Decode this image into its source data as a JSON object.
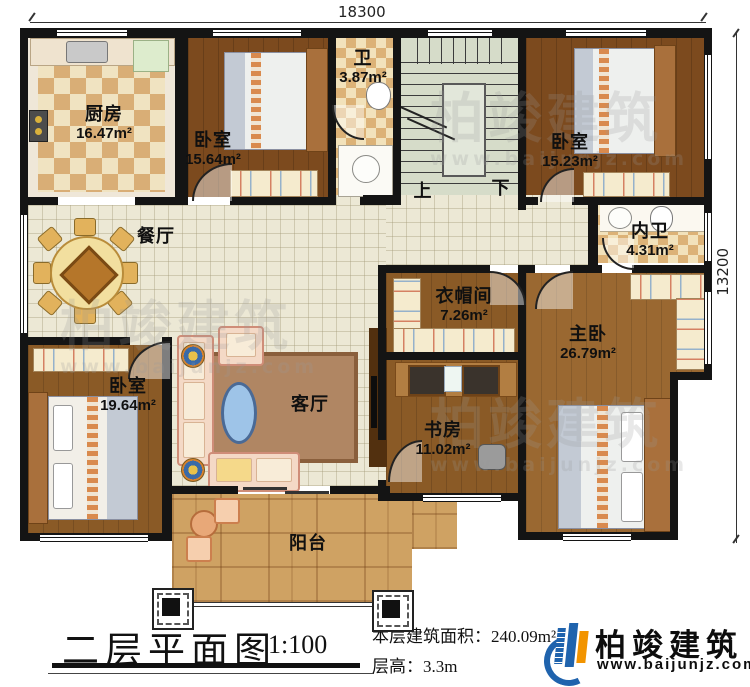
{
  "dimensions": {
    "top": "18300",
    "right": "13200"
  },
  "rooms": {
    "kitchen": {
      "name": "厨房",
      "area": "16.47m²"
    },
    "bedroom_top": {
      "name": "卧室",
      "area": "15.64m²"
    },
    "bath": {
      "name": "卫",
      "area": "3.87m²"
    },
    "bedroom_topright": {
      "name": "卧室",
      "area": "15.23m²"
    },
    "inner_bath": {
      "name": "内卫",
      "area": "4.31m²"
    },
    "dining": {
      "name": "餐厅",
      "area": ""
    },
    "cloakroom": {
      "name": "衣帽间",
      "area": "7.26m²"
    },
    "master": {
      "name": "主卧",
      "area": "26.79m²"
    },
    "bedroom_bottomleft": {
      "name": "卧室",
      "area": "19.64m²"
    },
    "living": {
      "name": "客厅",
      "area": ""
    },
    "study": {
      "name": "书房",
      "area": "11.02m²"
    },
    "balcony": {
      "name": "阳台",
      "area": ""
    }
  },
  "stairs": {
    "up": "上",
    "down": "下"
  },
  "caption": {
    "title": "二层平面图",
    "scale": "1:100",
    "area_label": "本层建筑面积：",
    "area_value": "240.09m²",
    "height_label": "层高：",
    "height_value": "3.3m"
  },
  "logo": {
    "name": "柏竣建筑",
    "url": "www.baijunjz.com"
  },
  "watermark": {
    "text": "柏竣建筑",
    "url": "www.baijunjz.com"
  },
  "colors": {
    "wall": "#141414",
    "tile": "#ece8d5",
    "wood": "#8a5a26",
    "stone": "#cfa263",
    "stairs": "#d6dcc9",
    "logo_blue": "#1f63ad",
    "logo_orange": "#f29400"
  }
}
